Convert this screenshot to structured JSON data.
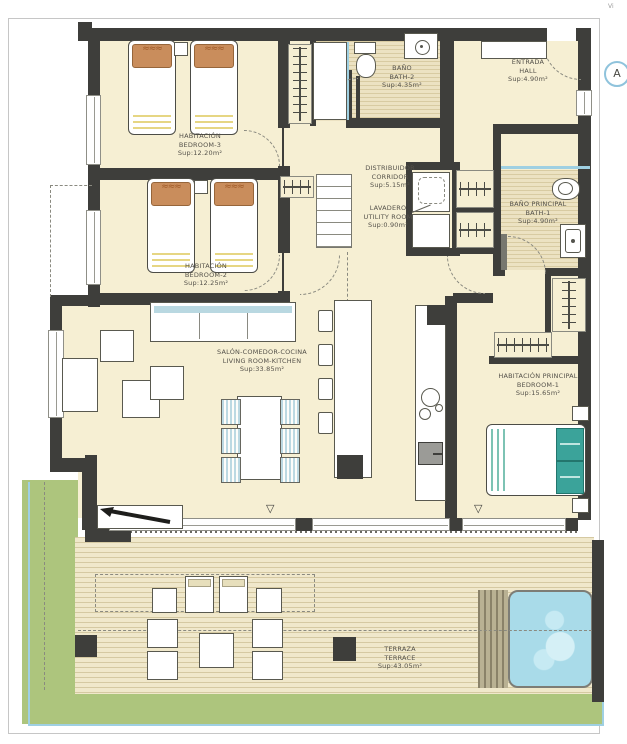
{
  "annotations": {
    "corner_note": "Vi",
    "marker_label": "A"
  },
  "symbols": {
    "triangle": "▽",
    "waves": "≈≈≈"
  },
  "rooms": {
    "bedroom3": {
      "name_es": "HABITACIÓN",
      "name_en": "BEDROOM-3",
      "area": "Sup:12.20m²"
    },
    "bedroom2": {
      "name_es": "HABITACIÓN",
      "name_en": "BEDROOM-2",
      "area": "Sup:12.25m²"
    },
    "living": {
      "name_es": "SALÓN-COMEDOR-COCINA",
      "name_en": "LIVING ROOM-KITCHEN",
      "area": "Sup:33.85m²"
    },
    "bath2": {
      "name_es": "BAÑO",
      "name_en": "BATH-2",
      "area": "Sup:4.35m²"
    },
    "hall": {
      "name_es": "ENTRADA",
      "name_en": "HALL",
      "area": "Sup:4.90m²"
    },
    "corridor": {
      "name_es": "DISTRIBUIDOR",
      "name_en": "CORRIDOR",
      "area": "Sup:5.15m²"
    },
    "utility": {
      "name_es": "LAVADERO",
      "name_en": "UTILITY ROOM",
      "area": "Sup:0.90m²"
    },
    "bath1": {
      "name_es": "BAÑO PRINCIPAL",
      "name_en": "BATH-1",
      "area": "Sup:4.90m²"
    },
    "bedroom1": {
      "name_es": "HABITACIÓN PRINCIPAL",
      "name_en": "BEDROOM-1",
      "area": "Sup:15.65m²"
    },
    "terrace": {
      "name_es": "TERRAZA",
      "name_en": "TERRACE",
      "area": "Sup:43.05m²"
    }
  },
  "colors": {
    "wall": "#3e3e3b",
    "room_fill": "#f6efd3",
    "green": "#adc57d",
    "pool_water": "#a9dbe9",
    "accent_blue": "#9fd0e2",
    "headboard": "#c98d5c",
    "teal_pillow": "#3ba39a",
    "marker_ring": "#8fc3dc"
  }
}
